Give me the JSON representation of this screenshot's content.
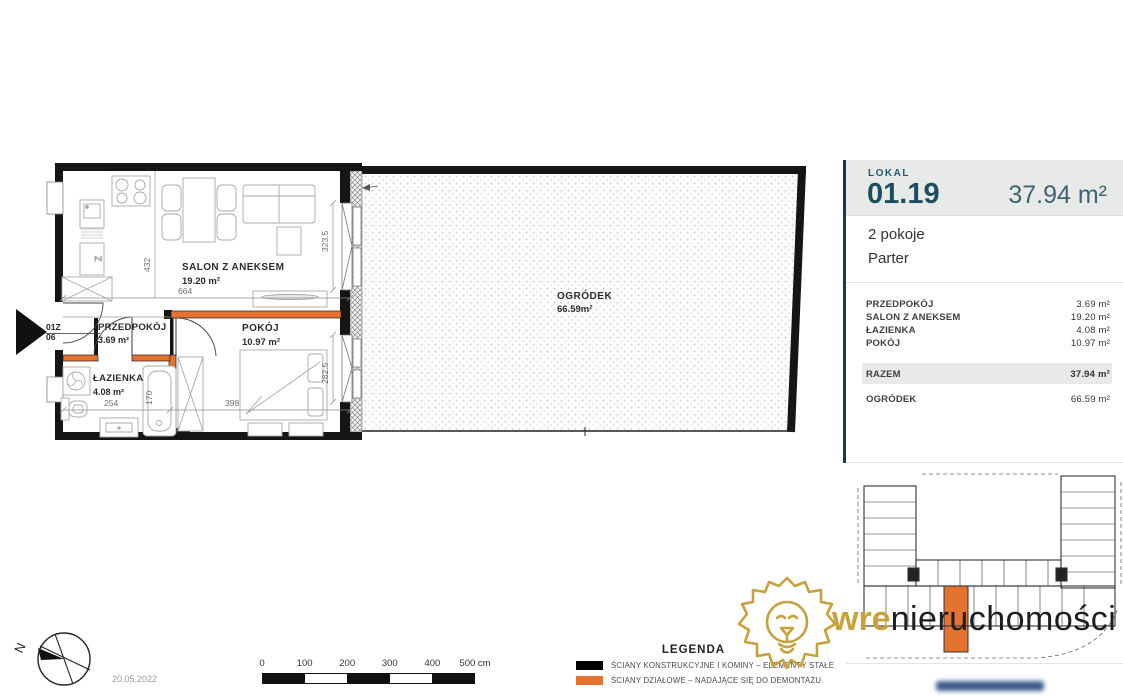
{
  "page": {
    "date": "20.05.2022"
  },
  "panel": {
    "lokal_label": "LOKAL",
    "unit_number": "01.19",
    "total_area": "37.94 m²",
    "rooms_count": "2 pokoje",
    "floor": "Parter",
    "rows": [
      {
        "name": "PRZEDPOKÓJ",
        "area": "3.69 m²"
      },
      {
        "name": "SALON Z ANEKSEM",
        "area": "19.20 m²"
      },
      {
        "name": "ŁAZIENKA",
        "area": "4.08 m²"
      },
      {
        "name": "POKÓJ",
        "area": "10.97 m²"
      }
    ],
    "total_row": {
      "name": "RAZEM",
      "area": "37.94 m²"
    },
    "garden_row": {
      "name": "OGRÓDEK",
      "area": "66.59 m²"
    }
  },
  "plan": {
    "salon": {
      "name": "SALON Z ANEKSEM",
      "area": "19.20 m²"
    },
    "przedpokoj": {
      "name": "PRZEDPOKÓJ",
      "area": "3.69 m²"
    },
    "pokoj": {
      "name": "POKÓJ",
      "area": "10.97 m²"
    },
    "lazienka": {
      "name": "ŁAZIENKA",
      "area": "4.08 m²"
    },
    "ogrodek": {
      "name": "OGRÓDEK",
      "area": "66.59m²"
    },
    "dims": {
      "d432": "432",
      "d664": "664",
      "d254": "254",
      "d170": "170",
      "d398": "398",
      "d3235": "323.5",
      "d2825": "282.5"
    },
    "entrance": {
      "line1": "01Z",
      "line2": "06"
    }
  },
  "legend": {
    "title": "LEGENDA",
    "items": [
      {
        "label": "ŚCIANY KONSTRUKCYJNE I KOMINY – ELEMENTY STAŁE",
        "color": "#000000"
      },
      {
        "label": "ŚCIANY DZIAŁOWE – NADAJĄCE SIĘ DO DEMONTAŻU",
        "color": "#e5732f"
      }
    ]
  },
  "scalebar": {
    "labels": [
      "0",
      "100",
      "200",
      "300",
      "400",
      "500 cm"
    ]
  },
  "compass": {
    "north": "N"
  },
  "logo": {
    "part1": "wre",
    "part2": "nieruchomości"
  },
  "colors": {
    "teal": "#25586b",
    "orange": "#e5732f",
    "gold": "#c7a23b",
    "panel_bg": "#e8e9e9",
    "accent_line": "#1b3a47",
    "wall_black": "#151515"
  }
}
